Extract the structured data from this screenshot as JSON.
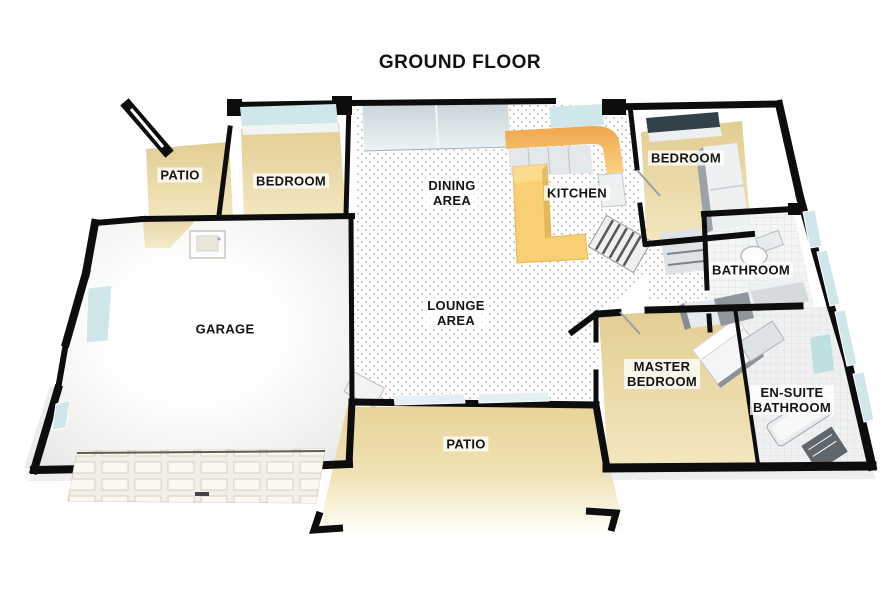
{
  "title": "GROUND FLOOR",
  "palette": {
    "wall": "#0d0d0d",
    "floor-tan": "#e7d49e",
    "floor-tan-light": "#f1e5bd",
    "counter-orange": "#f4b45f",
    "island-yellow": "#f8cf72",
    "glass-blue": "#cfe7ea",
    "window-dark": "#31424b",
    "tile-white": "#f4f5f5",
    "label-ink": "#141414",
    "label-bg": "rgba(255,255,255,0.78)"
  },
  "rooms": [
    {
      "id": "patio-top",
      "lines": [
        "PATIO"
      ]
    },
    {
      "id": "bedroom-left",
      "lines": [
        "BEDROOM"
      ]
    },
    {
      "id": "dining-area",
      "lines": [
        "DINING",
        "AREA"
      ]
    },
    {
      "id": "kitchen",
      "lines": [
        "KITCHEN"
      ]
    },
    {
      "id": "bedroom-right",
      "lines": [
        "BEDROOM"
      ]
    },
    {
      "id": "bathroom",
      "lines": [
        "BATHROOM"
      ]
    },
    {
      "id": "garage",
      "lines": [
        "GARAGE"
      ]
    },
    {
      "id": "lounge-area",
      "lines": [
        "LOUNGE",
        "AREA"
      ]
    },
    {
      "id": "master-bedroom",
      "lines": [
        "MASTER",
        "BEDROOM"
      ]
    },
    {
      "id": "ensuite-bathroom",
      "lines": [
        "EN-SUITE",
        "BATHROOM"
      ]
    },
    {
      "id": "patio-bottom",
      "lines": [
        "PATIO"
      ]
    }
  ]
}
